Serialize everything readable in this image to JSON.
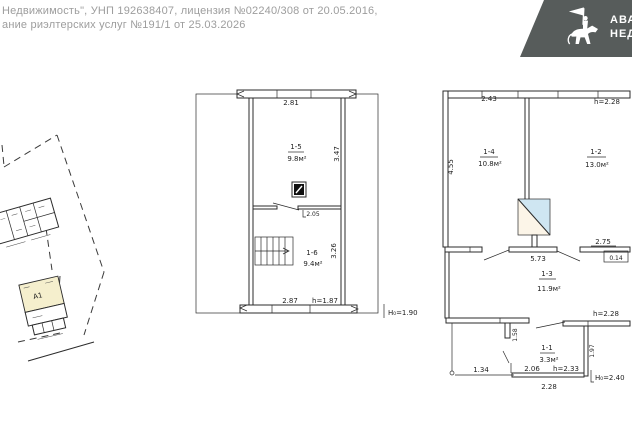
{
  "header": {
    "line1": "Недвижимость\", УНП 192638407, лицензия №02240/308 от 20.05.2016,",
    "line2": "ание риэлтерских услуг №191/1 от 25.03.2026"
  },
  "logo": {
    "bg_color": "#575c5b",
    "icon": "knight-on-horse",
    "text_line1": "АВАН",
    "text_line2": "НЕДВ"
  },
  "site_plan": {
    "building_label": "А1"
  },
  "attic_plan": {
    "dim_top": "2.81",
    "rooms": [
      {
        "number": "1-5",
        "area": "9.8м²"
      },
      {
        "number": "1-6",
        "area": "9.4м²"
      }
    ],
    "dim_right_top": "3.47",
    "dim_right_bottom": "3.26",
    "door_dim": "2.05",
    "dim_bottom": "2.87",
    "h_bottom": "h=1.87",
    "ceiling_height": "H₀=1.90"
  },
  "floor_plan": {
    "dim_top_left": "2.43",
    "h_top_right": "h=2.28",
    "dim_left": "4.55",
    "rooms": [
      {
        "number": "1-4",
        "area": "10.8м²"
      },
      {
        "number": "1-2",
        "area": "13.0м²"
      },
      {
        "number": "1-3",
        "area": "11.9м²"
      },
      {
        "number": "1-1",
        "area": "3.3м²"
      }
    ],
    "dim_wall_center": "5.73",
    "dim_wall_right": "2.75",
    "wall_thickness": "0.14",
    "h_mid_right": "h=2.28",
    "dim_stub": "1.58",
    "dim_right_vert": "1.97",
    "dim_bottom_left": "1.34",
    "door_bottom_width": "2.06",
    "door_bottom_height": "h=2.33",
    "dim_bottom_center": "2.28",
    "ceiling_height": "H₀=2.40"
  }
}
